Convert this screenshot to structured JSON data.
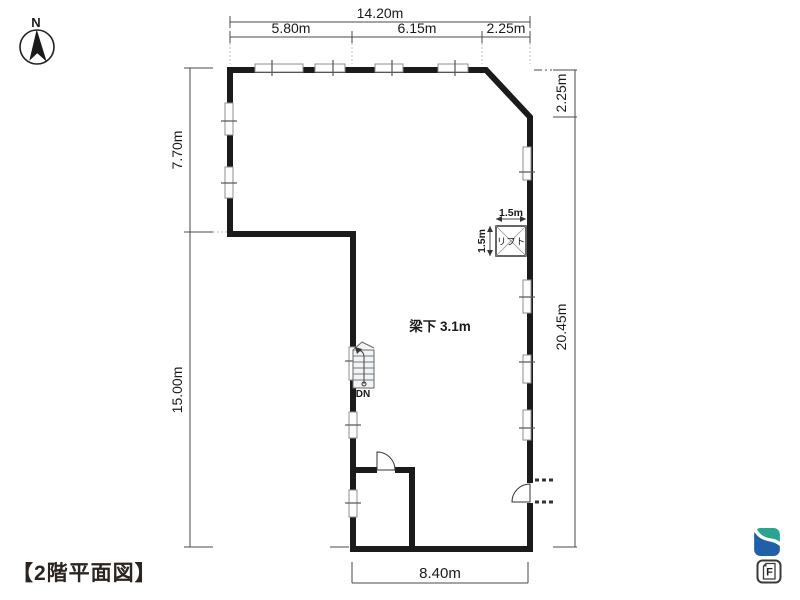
{
  "title": "【2階平面図】",
  "compass": {
    "label": "N"
  },
  "dims": {
    "top_total": "14.20m",
    "top_seg_1": "5.80m",
    "top_seg_2": "6.15m",
    "top_seg_3": "2.25m",
    "left_upper": "7.70m",
    "left_lower": "15.00m",
    "right_upper": "2.25m",
    "right_lower": "20.45m",
    "bottom": "8.40m"
  },
  "plan": {
    "beam_label": "梁下 3.1m",
    "lift_label": "リフト",
    "lift_width": "1.5m",
    "lift_depth": "1.5m",
    "stairs_down": "DN"
  },
  "footer": {
    "document_letter": "F"
  },
  "colors": {
    "floor_fill": "#d3ecf7",
    "wall": "#1b1b1b",
    "logo_teal": "#2aa391",
    "logo_blue": "#2060a8"
  }
}
